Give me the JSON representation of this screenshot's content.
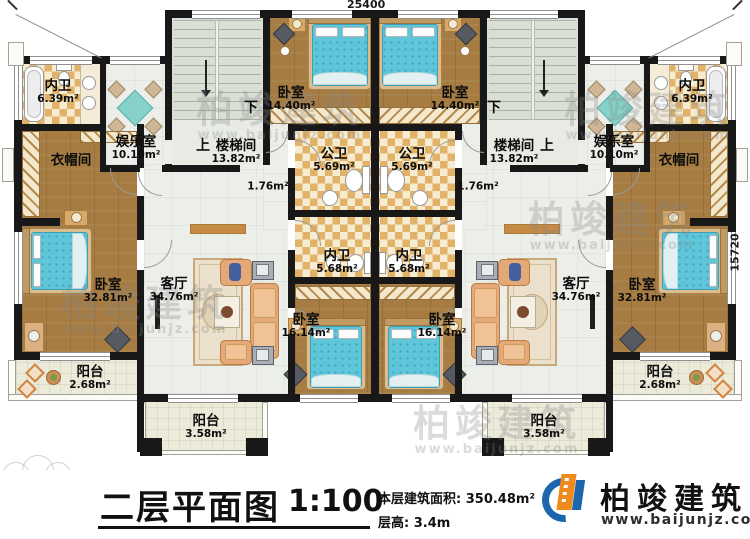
{
  "plan": {
    "dim_top": "25400",
    "dim_right": "15720"
  },
  "rooms": {
    "bath_small": {
      "name": "内卫",
      "area": "6.39m²"
    },
    "rec_room": {
      "name": "娱乐室",
      "area": "10.10m²"
    },
    "cloak": {
      "name": "衣帽间"
    },
    "stair": {
      "name": "楼梯间",
      "area": "13.82m²",
      "up": "上",
      "down": "下"
    },
    "bed_mid": {
      "name": "卧室",
      "area": "14.40m²"
    },
    "pub_bath": {
      "name": "公卫",
      "area": "5.69m²"
    },
    "hall": {
      "area": "1.76m²"
    },
    "bath_inner": {
      "name": "内卫",
      "area": "5.68m²"
    },
    "bed_inner": {
      "name": "卧室",
      "area": "16.14m²"
    },
    "bed_master": {
      "name": "卧室",
      "area": "32.81m²"
    },
    "living": {
      "name": "客厅",
      "area": "34.76m²"
    },
    "balcony_side": {
      "name": "阳台",
      "area": "2.68m²"
    },
    "balcony_front": {
      "name": "阳台",
      "area": "3.58m²"
    }
  },
  "title": {
    "text": "二层平面图",
    "scale": "1:100",
    "area_line": "本层建筑面积: 350.48m²",
    "height_line": "层高: 3.4m"
  },
  "brand": {
    "name": "柏竣建筑",
    "url": "www.baijunjz.com"
  },
  "colors": {
    "wall": "#181818",
    "wood_floor": "#a67c42",
    "bath_checker": "#e2b269",
    "bed_blue": "#5fc6da",
    "brand_blue": "#1c66ad",
    "brand_orange": "#ef8b1c"
  }
}
